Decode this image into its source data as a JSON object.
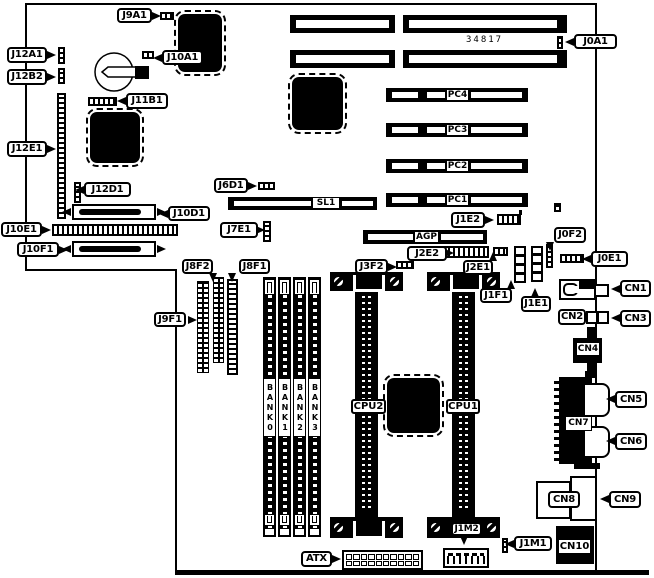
{
  "title": "Motherboard connector location diagram",
  "board_number": "34817",
  "labels": {
    "J9A1": "J9A1",
    "J0A1": "J0A1",
    "J12A1": "J12A1",
    "J10A1": "J10A1",
    "J12B2": "J12B2",
    "J11B1": "J11B1",
    "J12E1": "J12E1",
    "J12D1": "J12D1",
    "J6D1": "J6D1",
    "J10D1": "J10D1",
    "J10E1": "J10E1",
    "J7E1": "J7E1",
    "J10F1": "J10F1",
    "J8F2": "J8F2",
    "J8F1": "J8F1",
    "J9F1": "J9F1",
    "J3F2": "J3F2",
    "J2E2": "J2E2",
    "J2E1": "J2E1",
    "J1E2": "J1E2",
    "J1F1": "J1F1",
    "J1E1": "J1E1",
    "J0F2": "J0F2",
    "J0E1": "J0E1",
    "CN1": "CN1",
    "CN2": "CN2",
    "CN3": "CN3",
    "CN4": "CN4",
    "CN5": "CN5",
    "CN6": "CN6",
    "CN7": "CN7",
    "CN8": "CN8",
    "CN9": "CN9",
    "CN10": "CN10",
    "J1M1": "J1M1",
    "J1M2": "J1M2",
    "ATX": "ATX",
    "CPU1": "CPU1",
    "CPU2": "CPU2",
    "SL1": "SL1",
    "AGP": "AGP",
    "PC1": "PC1",
    "PC2": "PC2",
    "PC3": "PC3",
    "PC4": "PC4",
    "BANK0": "BANK0",
    "BANK1": "BANK1",
    "BANK2": "BANK2",
    "BANK3": "BANK3"
  },
  "colors": {
    "line": "#000000",
    "background": "#ffffff"
  }
}
